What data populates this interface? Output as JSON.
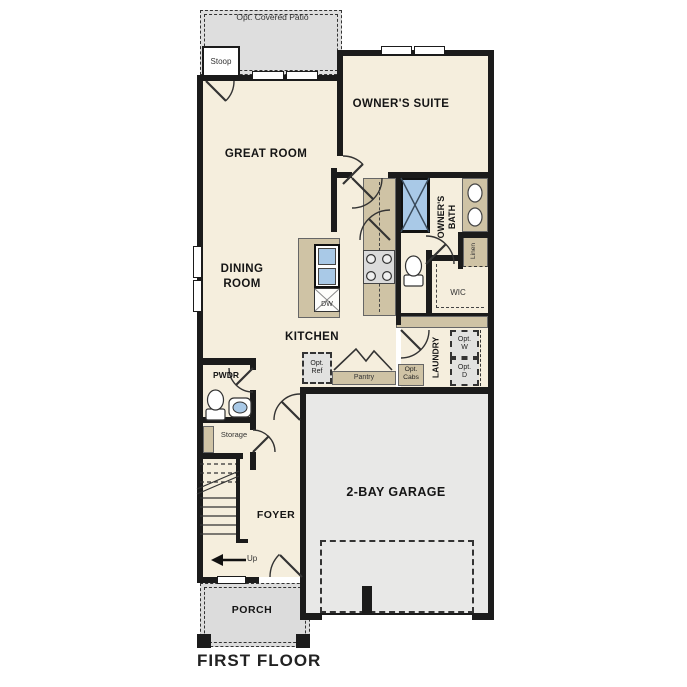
{
  "plan": {
    "title": "FIRST FLOOR",
    "rooms": {
      "patio": "Opt. Covered Patio",
      "stoop": "Stoop",
      "owners_suite": "OWNER'S SUITE",
      "great_room": "GREAT ROOM",
      "owners_bath": "OWNER'S BATH",
      "linen": "Linen",
      "wic": "WIC",
      "dining_room": "DINING ROOM",
      "kitchen": "KITCHEN",
      "laundry": "LAUNDRY",
      "pwdr": "PWDR",
      "storage": "Storage",
      "garage": "2-BAY GARAGE",
      "foyer": "FOYER",
      "porch": "PORCH"
    },
    "features": {
      "dw": "DW",
      "pantry": "Pantry",
      "opt_ref": "Opt. Ref",
      "opt_cabs": "Opt. Cabs",
      "opt_w": "Opt. W",
      "opt_d": "Opt. D",
      "up": "Up"
    },
    "colors": {
      "wall": "#1b1b1b",
      "room_fill": "#f5eedd",
      "outdoor_fill": "#dedede",
      "garage_fill": "#e8e8e7",
      "counter_tan": "#cfc3a5",
      "fixture_blue": "#a9c9e7",
      "optional_fill": "#e2e2e0"
    }
  }
}
